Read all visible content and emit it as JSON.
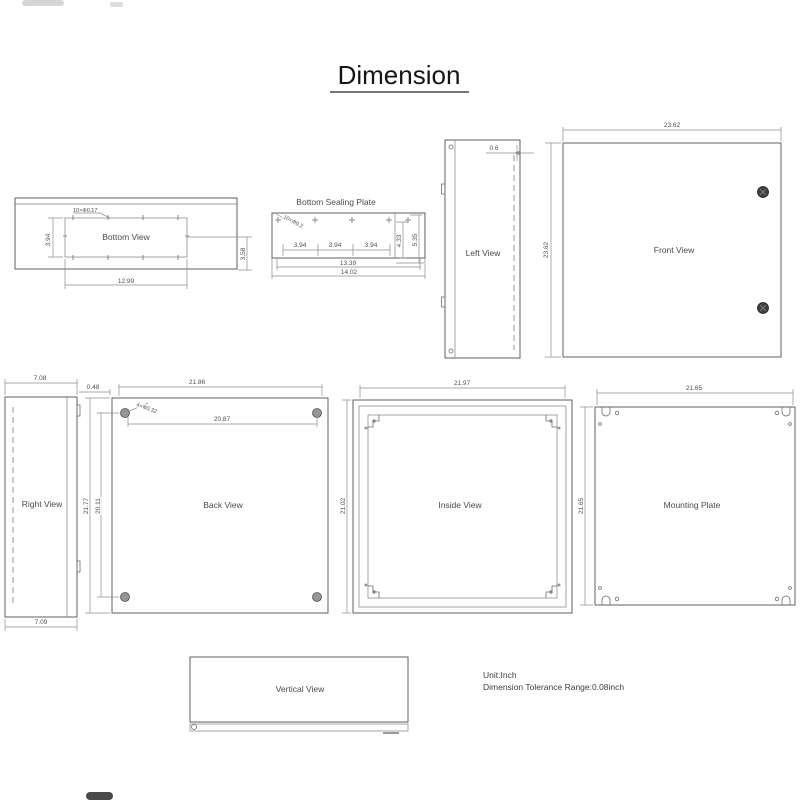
{
  "page": {
    "title": "Dimension"
  },
  "notes": {
    "unit": "Unit:Inch",
    "tolerance": "Dimension Tolerance Range:0.08inch"
  },
  "views": {
    "bottom": {
      "label": "Bottom View",
      "width": "12.99",
      "height": "3.94",
      "depth": "3.58",
      "holes": "10×Φ0.17"
    },
    "sealing_plate": {
      "title": "Bottom Sealing Plate",
      "spacings": [
        "3.94",
        "3.94",
        "3.94"
      ],
      "inner_width": "13.39",
      "outer_width": "14.02",
      "inner_height": "4.33",
      "outer_height": "5.35",
      "holes": "10×Φ0.2"
    },
    "left": {
      "label": "Left View",
      "wall": "0.6"
    },
    "front": {
      "label": "Front View",
      "width": "23.62",
      "height": "23.62"
    },
    "right": {
      "label": "Right View",
      "top_width": "7.08",
      "bottom_width": "7.09"
    },
    "back": {
      "label": "Back View",
      "width": "21.86",
      "hole_span_width": "20.87",
      "height": "21.77",
      "hole_span_height": "20.11",
      "edge_gap": "0.48",
      "holes": "4×Φ0.32"
    },
    "inside": {
      "label": "Inside View",
      "width": "21.97",
      "height": "21.02"
    },
    "mounting": {
      "label": "Mounting Plate",
      "width": "21.65",
      "height": "21.65"
    },
    "vertical": {
      "label": "Vertical View"
    }
  },
  "colors": {
    "line": "#7e7e7e",
    "text": "#4f4f4f",
    "knob": "#3f3f3f"
  }
}
